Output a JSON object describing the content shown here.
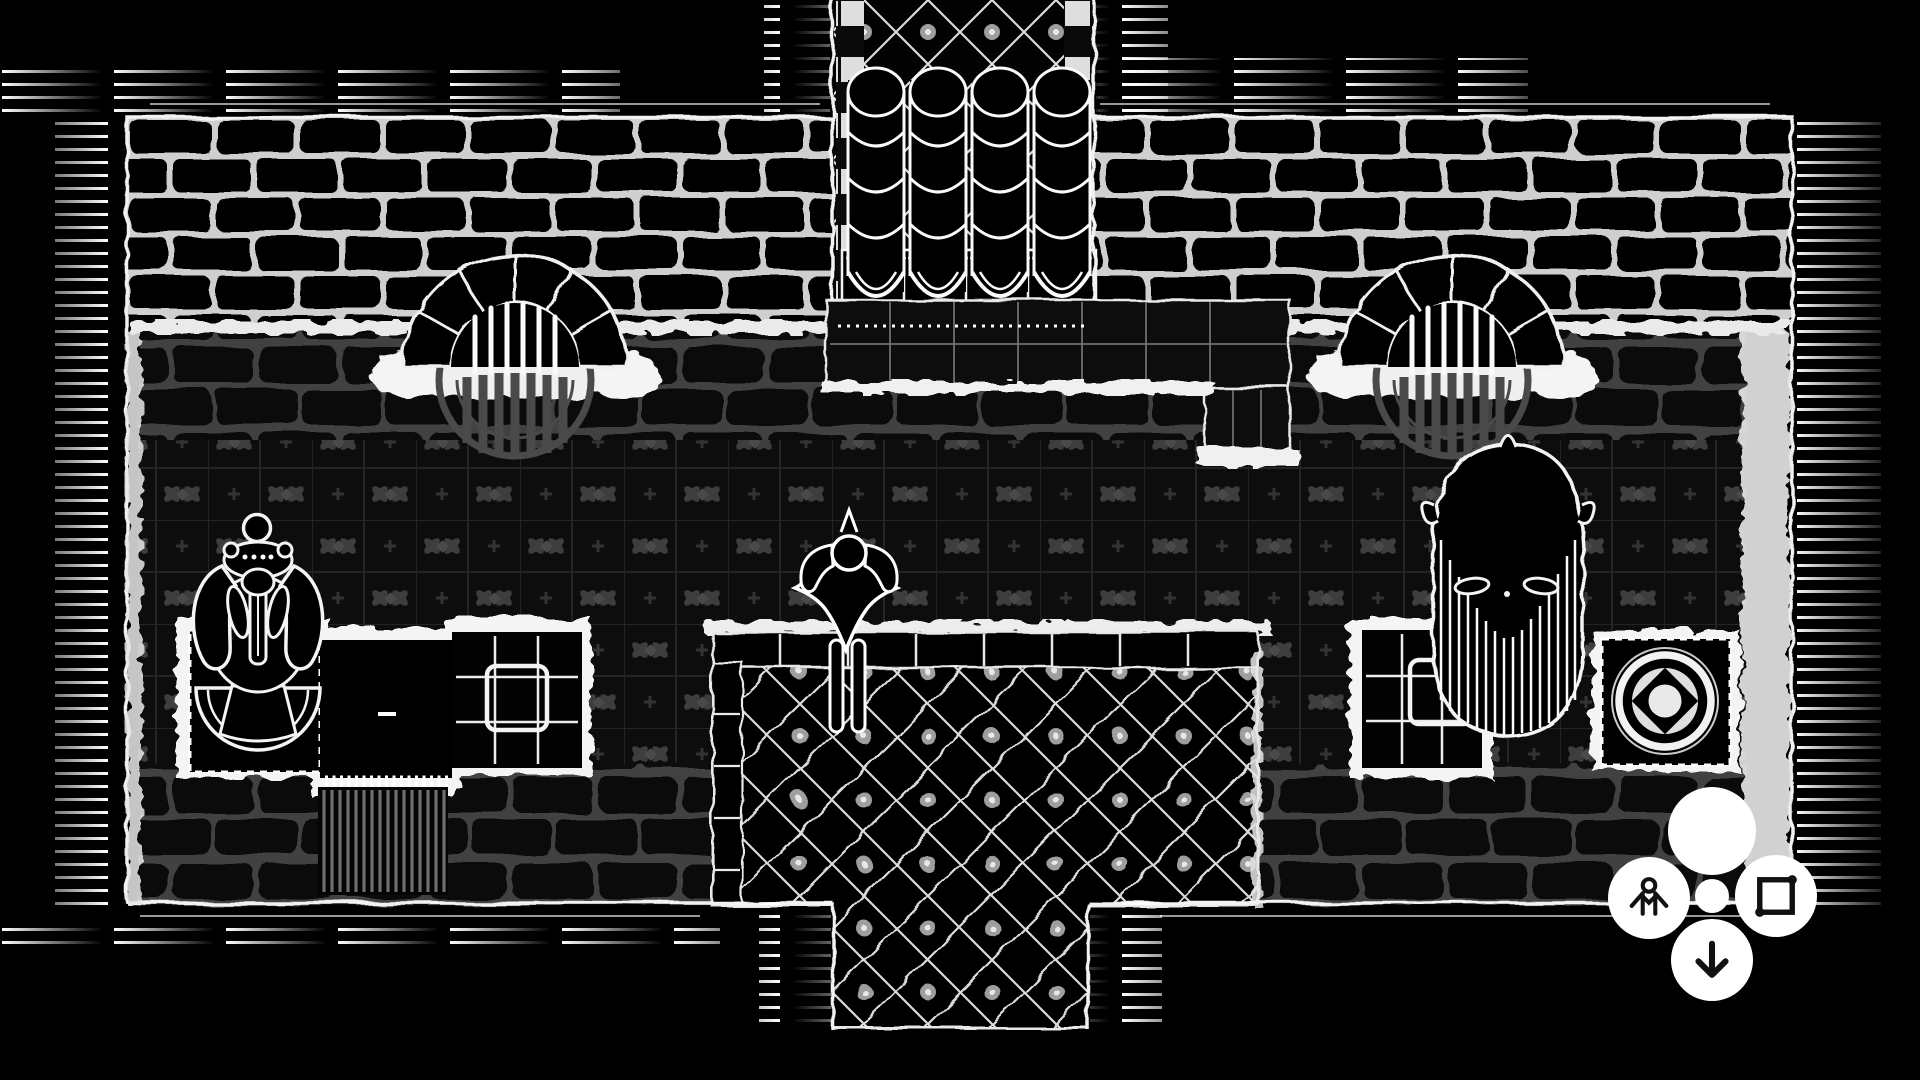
{
  "app": {
    "name": "dungeon-map-battle-screen",
    "style": "hand-drawn black and white top-down dungeon map"
  },
  "colors": {
    "background": "#000000",
    "ink": "#f2f2f2",
    "wall_mortar": "#d5d5d5",
    "floor_mortar": "#4c4c4c",
    "tile_motif": "#3e3e3e",
    "grate_grey": "#4a4a4a",
    "dais_line": "#dcdcdc",
    "button_bg": "#ffffff",
    "icon_ink": "#111111"
  },
  "map": {
    "rooms": [
      {
        "id": "great-hall",
        "description": "large hall with ornate tiled floor, brick walls top, hatched outer border"
      },
      {
        "id": "organ-alcove",
        "description": "north alcove with four-column pipe organ, checkered trim and diamond tile floor"
      },
      {
        "id": "south-corridor",
        "description": "corridor of diamond tiles leading off bottom edge"
      }
    ],
    "features": [
      {
        "id": "hearth-left",
        "description": "arched stone hearth with barred grate and round floor vent"
      },
      {
        "id": "hearth-right",
        "description": "arched stone hearth with barred grate and round floor vent"
      },
      {
        "id": "pipe-organ",
        "description": "four stacked pipe columns on bolted base plates with tiled ledge"
      },
      {
        "id": "gargoyle-statue",
        "description": "ornate winged statue on dashed-border mat"
      },
      {
        "id": "black-table",
        "description": "black table with fringe and striped runner rug below"
      },
      {
        "id": "quilt-tile-left",
        "description": "gridded padded tile"
      },
      {
        "id": "quilt-tile-right",
        "description": "gridded padded tile"
      },
      {
        "id": "bearded-head-statue",
        "description": "giant horned head with long striped beard"
      },
      {
        "id": "seal-mat",
        "description": "dashed-border mat with ring, diamond and center disc seal"
      },
      {
        "id": "dais",
        "description": "raised diamond-tiled platform with brick edging and rosettes"
      },
      {
        "id": "hero-figure",
        "description": "cloaked figure token standing at north edge of dais, hands to head"
      }
    ]
  },
  "controls": {
    "cluster_position": "bottom-right",
    "buttons": [
      {
        "id": "primary",
        "label": "Primary action",
        "icon": "circle-blank"
      },
      {
        "id": "token",
        "label": "Character",
        "icon": "person-icon"
      },
      {
        "id": "draw-shape",
        "label": "Select area",
        "icon": "square-icon"
      },
      {
        "id": "move-down",
        "label": "Move down",
        "icon": "arrow-down-icon"
      },
      {
        "id": "hub",
        "label": "Control hub",
        "icon": "dot"
      }
    ]
  }
}
